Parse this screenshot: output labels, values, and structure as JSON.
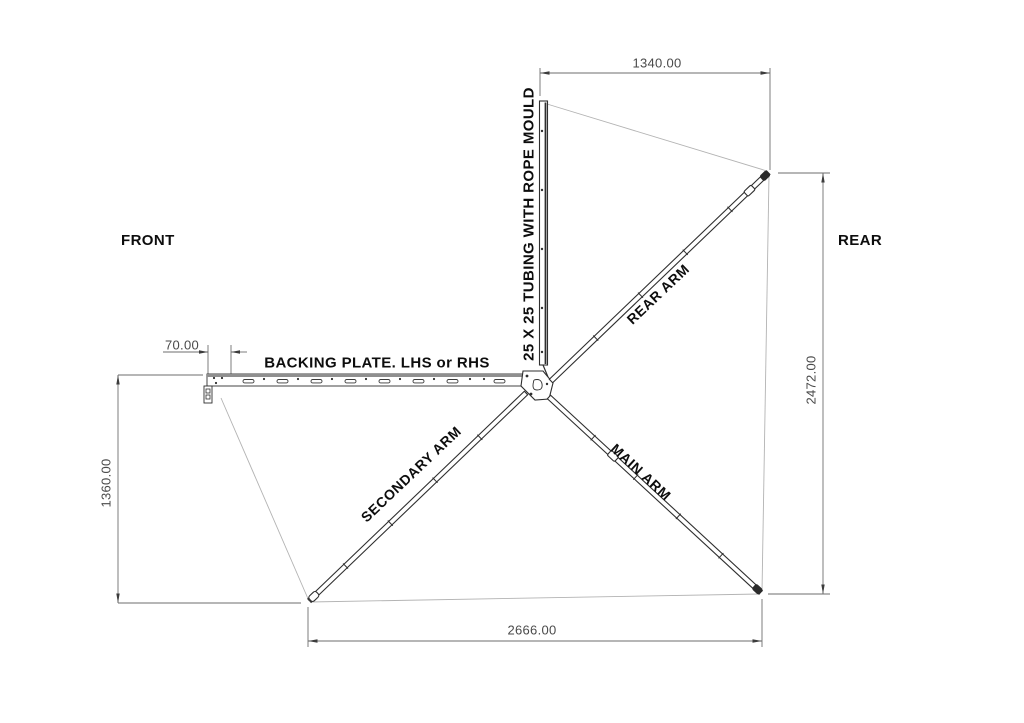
{
  "drawing": {
    "title": "Awning frame layout drawing",
    "labels": {
      "front": "FRONT",
      "rear": "REAR",
      "backing_plate": "BACKING PLATE. LHS or RHS",
      "tubing": "25 X 25 TUBING WITH ROPE MOULD",
      "rear_arm": "REAR ARM",
      "main_arm": "MAIN ARM",
      "secondary_arm": "SECONDARY ARM"
    },
    "dimensions": {
      "top_width": "1340.00",
      "plate_offset": "70.00",
      "front_height": "1360.00",
      "rear_height": "2472.00",
      "bottom_width": "2666.00"
    },
    "colors": {
      "line": "#2f2f2f",
      "dim_line": "#6e6e6e",
      "fabric_line": "#b3b3b3",
      "text": "#0d0d0d",
      "dim_text": "#4a4a4a"
    }
  }
}
